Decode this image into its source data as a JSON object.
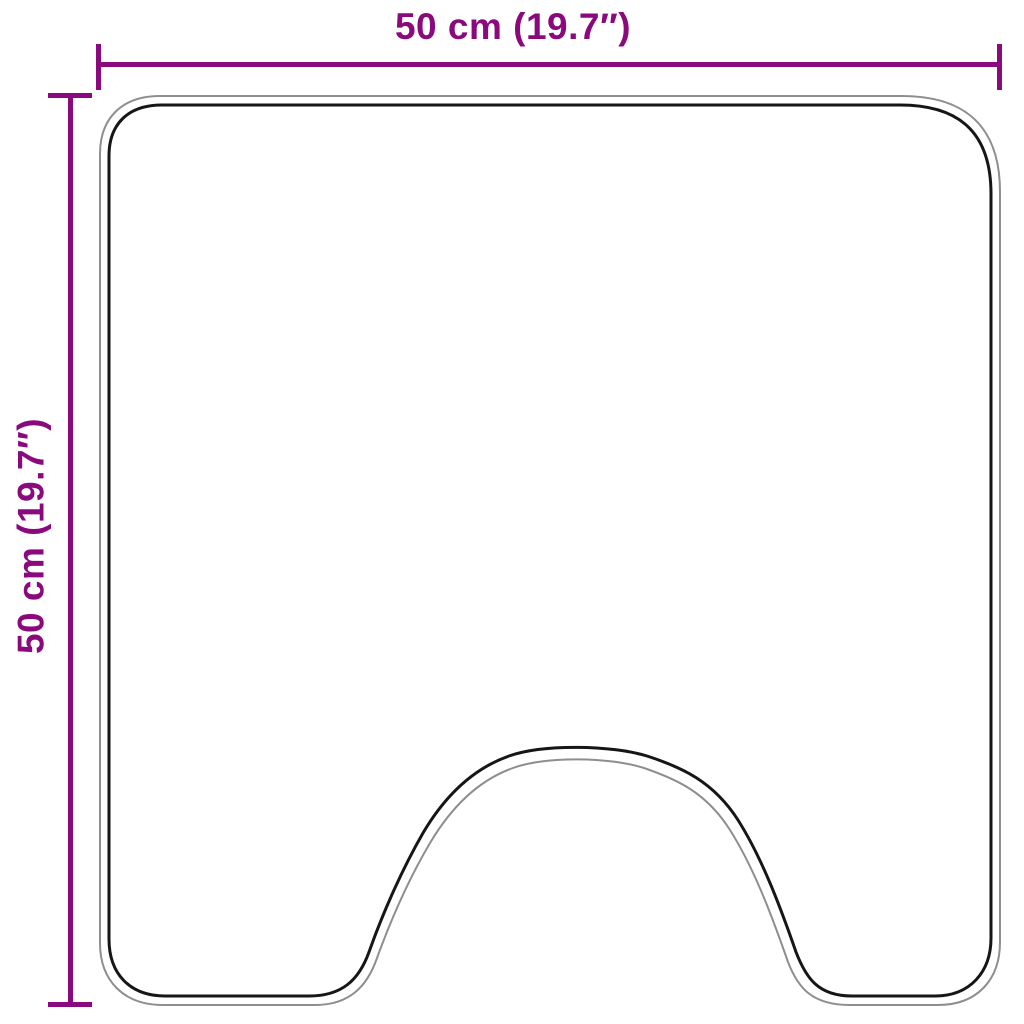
{
  "diagram": {
    "type": "product-dimension-diagram",
    "shape": "toilet-pedestal-mat-outline",
    "dimensions": {
      "width_label": "50 cm (19.7″)",
      "height_label": "50 cm (19.7″)"
    }
  },
  "colors": {
    "dimension": "#8A0A7D",
    "outline_inner": "#161616",
    "outline_outer": "#8E8E8E",
    "background": "#FFFFFF"
  }
}
